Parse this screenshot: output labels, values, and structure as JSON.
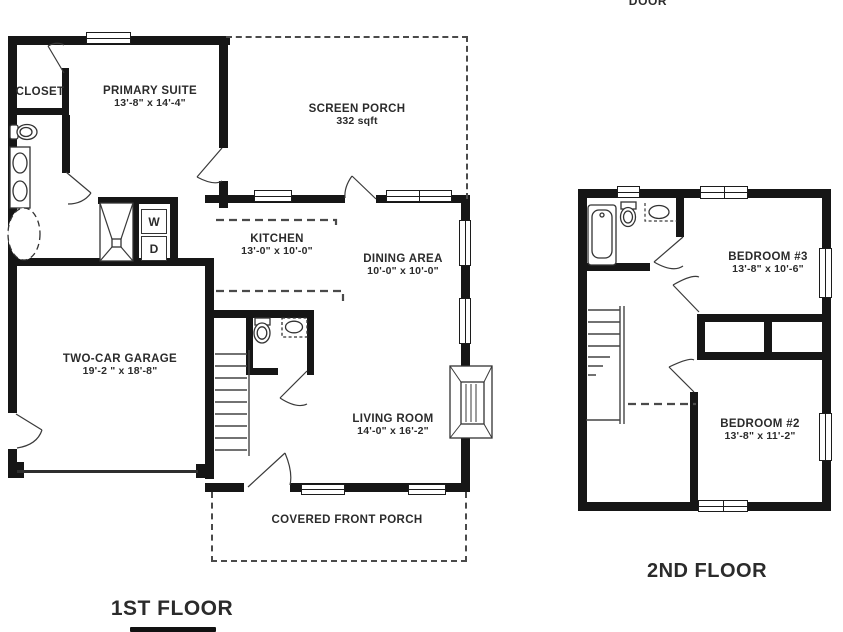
{
  "page": {
    "top_door_label": "DOOR"
  },
  "floor1": {
    "title": "1ST FLOOR",
    "rooms": {
      "closet": {
        "name": "CLOSET"
      },
      "primary_suite": {
        "name": "PRIMARY SUITE",
        "dims": "13'-8\" x 14'-4\""
      },
      "screen_porch": {
        "name": "SCREEN PORCH",
        "area": "332 sqft"
      },
      "kitchen": {
        "name": "KITCHEN",
        "dims": "13'-0\" x 10'-0\""
      },
      "dining_area": {
        "name": "DINING AREA",
        "dims": "10'-0\" x 10'-0\""
      },
      "garage": {
        "name": "TWO-CAR GARAGE",
        "dims": "19'-2 \" x 18'-8\""
      },
      "living_room": {
        "name": "LIVING ROOM",
        "dims": "14'-0\" x 16'-2\""
      },
      "front_porch": {
        "name": "COVERED FRONT PORCH"
      }
    },
    "appliances": {
      "washer": "W",
      "dryer": "D"
    }
  },
  "floor2": {
    "title": "2ND FLOOR",
    "rooms": {
      "bedroom3": {
        "name": "BEDROOM #3",
        "dims": "13'-8\" x 10'-6\""
      },
      "bedroom2": {
        "name": "BEDROOM #2",
        "dims": "13'-8\" x 11'-2\""
      }
    }
  },
  "colors": {
    "wall": "#161616",
    "text": "#2b2b2b",
    "dashed": "#4a4a4a",
    "background": "#ffffff"
  }
}
